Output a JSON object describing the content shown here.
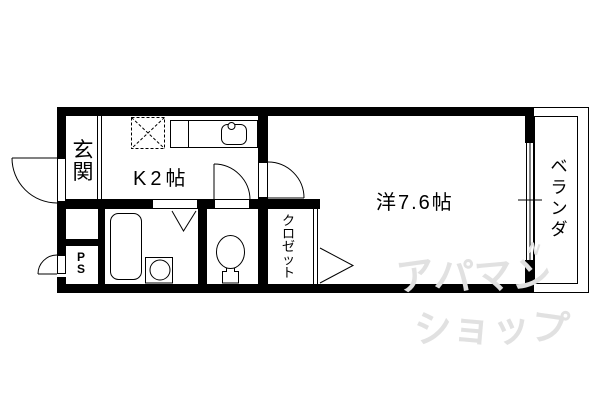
{
  "labels": {
    "genkan": "玄関",
    "kitchen": "K2帖",
    "main_room": "洋7.6帖",
    "closet": "クロゼット",
    "veranda": "ベランダ",
    "pipe_space": "PS"
  },
  "watermark": {
    "line1": "アパマン",
    "line2": "ショップ",
    "mark": "N"
  },
  "colors": {
    "wall": "#000000",
    "background": "#ffffff",
    "watermark": "#e1e1e1"
  }
}
